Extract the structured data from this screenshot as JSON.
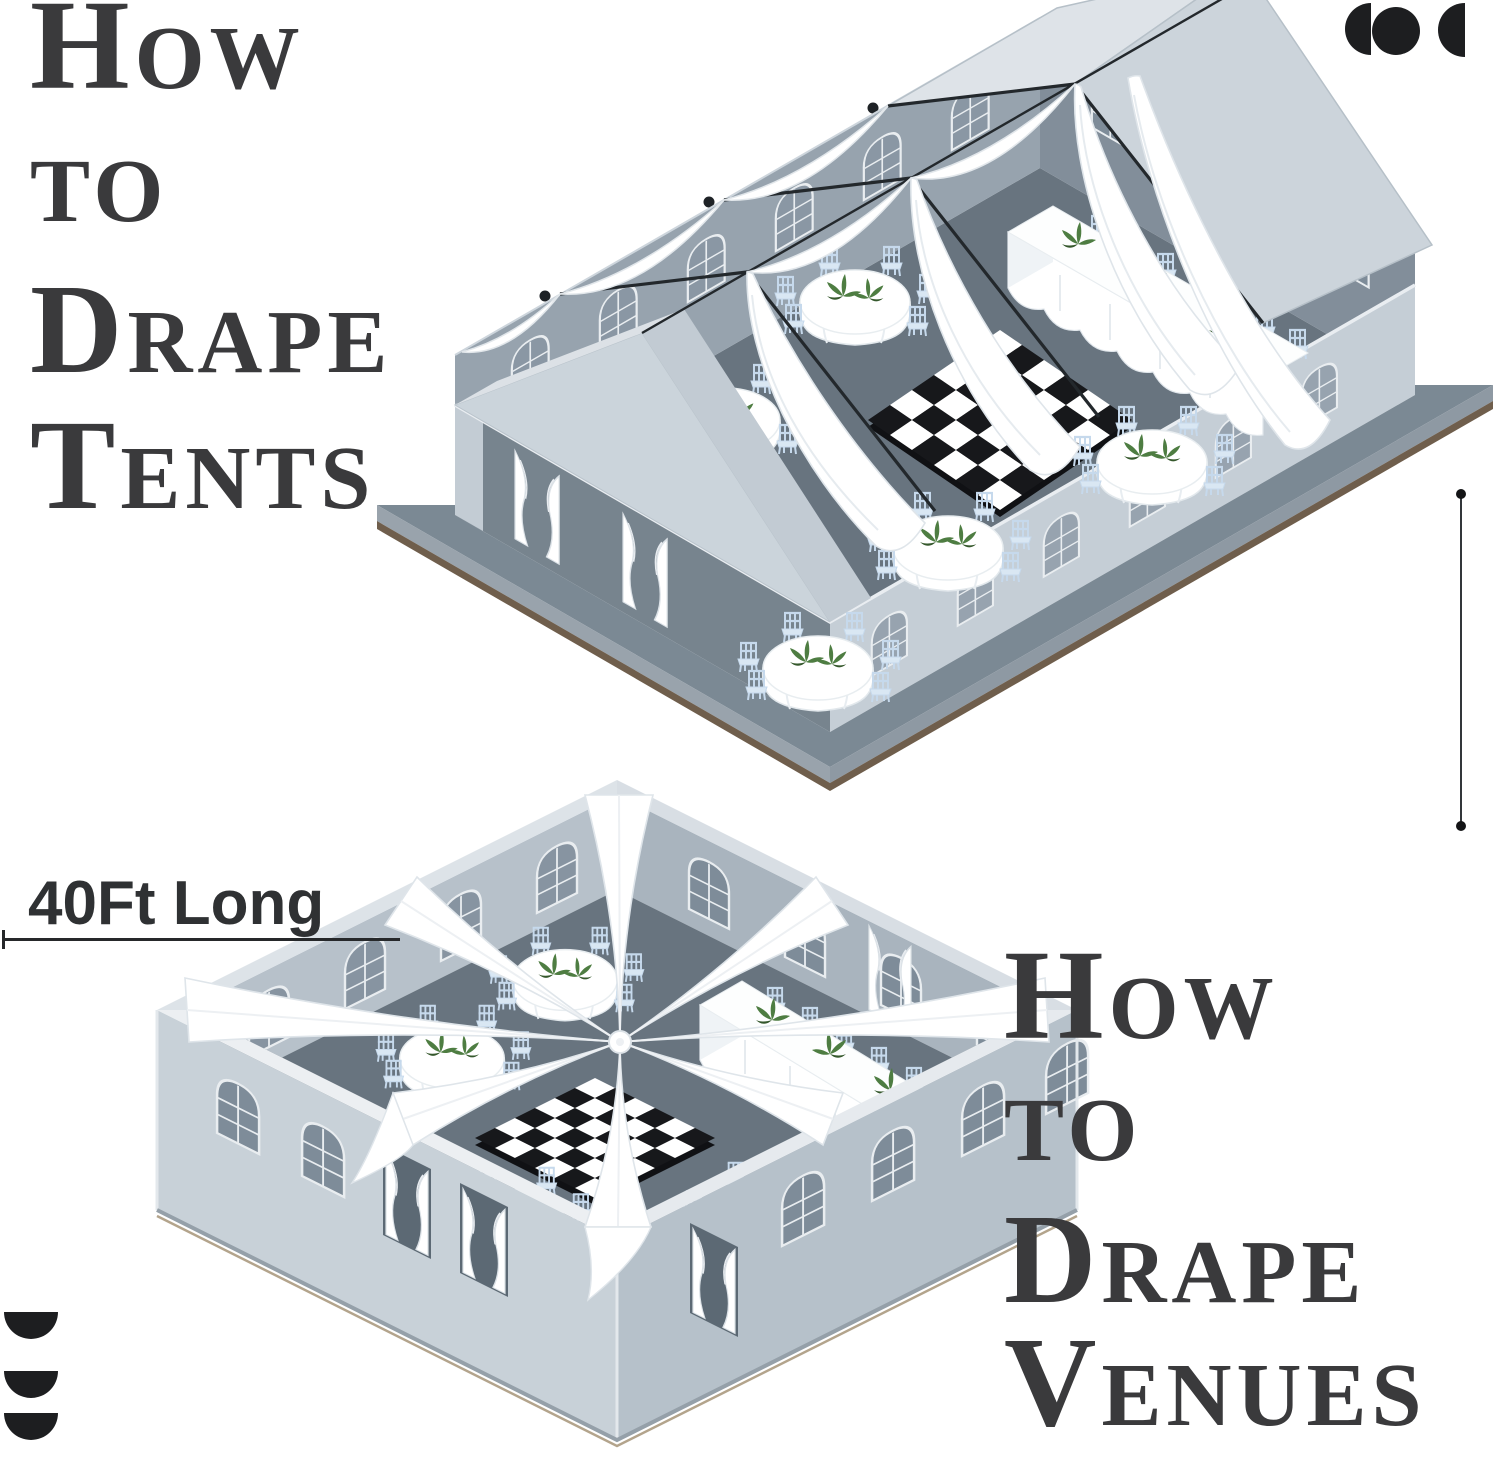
{
  "page": {
    "width": 1500,
    "height": 1469,
    "background": "#FFFFFF"
  },
  "titles": {
    "tents": {
      "lines": [
        "How",
        "to",
        "Drape",
        "Tents"
      ],
      "color": "#3A3A3C"
    },
    "venues": {
      "lines": [
        "How",
        "to",
        "Drape",
        "Venues"
      ],
      "color": "#3A3A3C"
    }
  },
  "annotations": {
    "length_label": "40Ft Long",
    "label_color": "#2F3133",
    "rule_color": "#26282A",
    "vertical_rule_present": true
  },
  "branding": {
    "top_right_logo": "crescent-dots-logo",
    "bottom_left_logo": "stacked-half-moons-logo",
    "logo_color": "#1D1E20"
  },
  "palette": {
    "wall_light": "#C8D1D8",
    "wall_shadow": "#77848E",
    "interior_floor": "#68747F",
    "platform_band": "#7B8994",
    "platform_edge_brown": "#6F5E4C",
    "roof_light": "#DEE3E8",
    "roof_dark": "#CCD4DB",
    "frame_black": "#23282C",
    "drape_white": "#FFFFFF",
    "chair_blue": "#C6D9EC",
    "greenery": "#4E7D42",
    "checker_dark": "#17181B",
    "checker_light": "#FFFFFF"
  },
  "scenes": {
    "tent": {
      "name": "isometric-frame-tent-with-ceiling-drapes",
      "ceiling_frames": 3,
      "wall_swags": 5,
      "sweeping_ceiling_drapes": 4,
      "round_tables": 5,
      "head_tables": 1,
      "head_table_chairs": 7,
      "dance_floor": "black-white-checkered",
      "window_style": "arched",
      "entrance_curtains": 2
    },
    "venue": {
      "name": "isometric-open-venue-with-radial-drapes",
      "radial_drapes": 8,
      "round_tables": 6,
      "head_tables": 1,
      "head_table_chairs": 5,
      "dance_floor": "black-white-checkered",
      "window_style": "arched",
      "entrance_curtains": 5
    }
  }
}
